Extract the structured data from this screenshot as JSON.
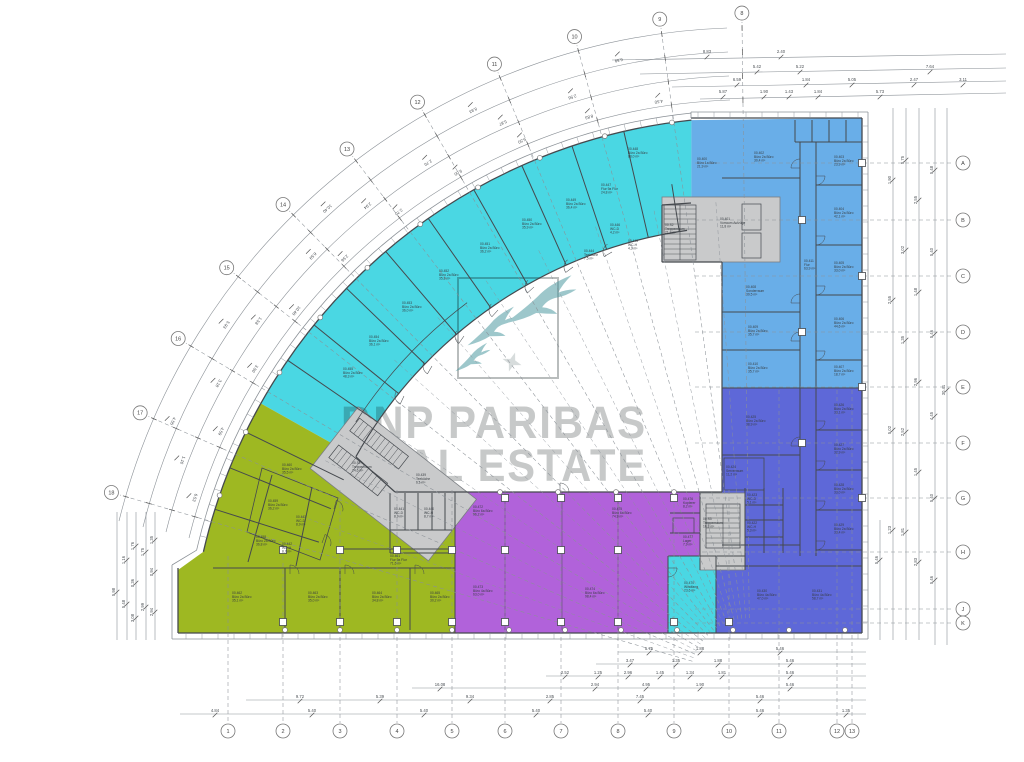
{
  "watermark": {
    "line1": "BNP PARIBAS",
    "line2": "REAL ESTATE",
    "color": "#c7c9c9",
    "logo": "bnp-paribas-swallows-logo",
    "logo_stroke": "#b9bdbd",
    "bird_color": "#4e9aa0",
    "star_color": "#cdd3d3"
  },
  "palette": {
    "cyan": "#4ad7e3",
    "blue": "#69aee8",
    "indigo": "#5e68d8",
    "purple": "#b162da",
    "green": "#9eb822",
    "core_gray": "#c9cacb",
    "wall": "#45494e",
    "dim": "#8b9197",
    "label": "#383d42",
    "background": "#ffffff"
  },
  "zones": [
    {
      "id": "curve-north",
      "color_key": "cyan"
    },
    {
      "id": "wing-east-upper",
      "color_key": "blue"
    },
    {
      "id": "wing-east-lower",
      "color_key": "indigo"
    },
    {
      "id": "wing-south-left",
      "color_key": "green"
    },
    {
      "id": "wing-south-center",
      "color_key": "purple"
    },
    {
      "id": "lobby-south",
      "color_key": "cyan"
    }
  ],
  "grid": {
    "bottom": {
      "y": 731,
      "items": [
        {
          "x": 228,
          "label": "1"
        },
        {
          "x": 283,
          "label": "2"
        },
        {
          "x": 340,
          "label": "3"
        },
        {
          "x": 397,
          "label": "4"
        },
        {
          "x": 452,
          "label": "5"
        },
        {
          "x": 505,
          "label": "6"
        },
        {
          "x": 561,
          "label": "7"
        },
        {
          "x": 618,
          "label": "8"
        },
        {
          "x": 674,
          "label": "9"
        },
        {
          "x": 729,
          "label": "10"
        },
        {
          "x": 779,
          "label": "11"
        },
        {
          "x": 837,
          "label": "12"
        },
        {
          "x": 852,
          "label": "13"
        }
      ]
    },
    "right": {
      "x": 963,
      "items": [
        {
          "y": 163,
          "label": "A"
        },
        {
          "y": 220,
          "label": "B"
        },
        {
          "y": 276,
          "label": "C"
        },
        {
          "y": 332,
          "label": "D"
        },
        {
          "y": 387,
          "label": "E"
        },
        {
          "y": 443,
          "label": "F"
        },
        {
          "y": 498,
          "label": "G"
        },
        {
          "y": 552,
          "label": "H"
        },
        {
          "y": 609,
          "label": "J"
        },
        {
          "y": 623,
          "label": "K"
        }
      ]
    },
    "arc": {
      "r": 665,
      "items": [
        {
          "phi": 269.3,
          "label": "8"
        },
        {
          "phi": 262.2,
          "label": "9"
        },
        {
          "phi": 254.7,
          "label": "10"
        },
        {
          "phi": 247.4,
          "label": "11"
        },
        {
          "phi": 240.0,
          "label": "12"
        },
        {
          "phi": 232.7,
          "label": "13"
        },
        {
          "phi": 225.4,
          "label": "14"
        },
        {
          "phi": 218.1,
          "label": "15"
        },
        {
          "phi": 210.7,
          "label": "16"
        },
        {
          "phi": 203.5,
          "label": "17"
        },
        {
          "phi": 196.2,
          "label": "18"
        }
      ]
    }
  },
  "dim_numbers": {
    "top": [
      {
        "x": 707,
        "y": 53,
        "t": "8.83"
      },
      {
        "x": 781,
        "y": 53,
        "t": "2.40"
      },
      {
        "x": 757,
        "y": 68,
        "t": "5.42"
      },
      {
        "x": 800,
        "y": 68,
        "t": "5.22"
      },
      {
        "x": 930,
        "y": 68,
        "t": "7.64"
      },
      {
        "x": 737,
        "y": 81,
        "t": "6.59"
      },
      {
        "x": 806,
        "y": 81,
        "t": "1.84"
      },
      {
        "x": 852,
        "y": 81,
        "t": "5.05"
      },
      {
        "x": 914,
        "y": 81,
        "t": "2.47"
      },
      {
        "x": 963,
        "y": 81,
        "t": "3.11"
      },
      {
        "x": 723,
        "y": 93,
        "t": "5.87"
      },
      {
        "x": 764,
        "y": 93,
        "t": "1.90"
      },
      {
        "x": 789,
        "y": 93,
        "t": "1.43"
      },
      {
        "x": 818,
        "y": 93,
        "t": "1.84"
      },
      {
        "x": 880,
        "y": 93,
        "t": "5.73"
      }
    ],
    "bottom": [
      {
        "x": 649,
        "y": 650,
        "t": "5.75"
      },
      {
        "x": 700,
        "y": 650,
        "t": "1.88"
      },
      {
        "x": 780,
        "y": 650,
        "t": "5.46"
      },
      {
        "x": 630,
        "y": 662,
        "t": "3.47"
      },
      {
        "x": 676,
        "y": 662,
        "t": "1.35"
      },
      {
        "x": 718,
        "y": 662,
        "t": "1.88"
      },
      {
        "x": 790,
        "y": 662,
        "t": "5.46"
      },
      {
        "x": 565,
        "y": 674,
        "t": "2.52"
      },
      {
        "x": 598,
        "y": 674,
        "t": "1.25"
      },
      {
        "x": 628,
        "y": 674,
        "t": "2.96"
      },
      {
        "x": 660,
        "y": 674,
        "t": "1.45"
      },
      {
        "x": 690,
        "y": 674,
        "t": "1.34"
      },
      {
        "x": 722,
        "y": 674,
        "t": "1.81"
      },
      {
        "x": 790,
        "y": 674,
        "t": "5.46"
      },
      {
        "x": 440,
        "y": 686,
        "t": "16.08"
      },
      {
        "x": 595,
        "y": 686,
        "t": "2.94"
      },
      {
        "x": 646,
        "y": 686,
        "t": "4.95"
      },
      {
        "x": 700,
        "y": 686,
        "t": "1.90"
      },
      {
        "x": 790,
        "y": 686,
        "t": "5.46"
      },
      {
        "x": 300,
        "y": 698,
        "t": "9.72"
      },
      {
        "x": 380,
        "y": 698,
        "t": "5.39"
      },
      {
        "x": 470,
        "y": 698,
        "t": "9.34"
      },
      {
        "x": 550,
        "y": 698,
        "t": "2.85"
      },
      {
        "x": 640,
        "y": 698,
        "t": "7.45"
      },
      {
        "x": 760,
        "y": 698,
        "t": "5.46"
      },
      {
        "x": 215,
        "y": 712,
        "t": "4.84"
      },
      {
        "x": 312,
        "y": 712,
        "t": "5.40"
      },
      {
        "x": 424,
        "y": 712,
        "t": "5.40"
      },
      {
        "x": 536,
        "y": 712,
        "t": "5.40"
      },
      {
        "x": 648,
        "y": 712,
        "t": "5.40"
      },
      {
        "x": 760,
        "y": 712,
        "t": "5.46"
      },
      {
        "x": 846,
        "y": 712,
        "t": "1.35"
      }
    ],
    "left": [
      {
        "x": 117,
        "y": 592,
        "t": "5.98"
      },
      {
        "x": 127,
        "y": 560,
        "t": "1.16"
      },
      {
        "x": 127,
        "y": 604,
        "t": "5.48"
      },
      {
        "x": 136,
        "y": 546,
        "t": "1.76"
      },
      {
        "x": 136,
        "y": 583,
        "t": "0.36"
      },
      {
        "x": 136,
        "y": 618,
        "t": "3.08"
      },
      {
        "x": 146,
        "y": 552,
        "t": "1.75"
      },
      {
        "x": 146,
        "y": 607,
        "t": "2.99"
      },
      {
        "x": 155,
        "y": 540,
        "t": "1.35"
      },
      {
        "x": 155,
        "y": 572,
        "t": "0.94"
      },
      {
        "x": 155,
        "y": 612,
        "t": "2.94"
      }
    ],
    "right": [
      {
        "x": 880,
        "y": 560,
        "t": "5.46"
      },
      {
        "x": 893,
        "y": 180,
        "t": "1.90"
      },
      {
        "x": 893,
        "y": 300,
        "t": "2.55"
      },
      {
        "x": 893,
        "y": 430,
        "t": "5.02"
      },
      {
        "x": 893,
        "y": 530,
        "t": "1.23"
      },
      {
        "x": 906,
        "y": 160,
        "t": "5.75"
      },
      {
        "x": 906,
        "y": 250,
        "t": "3.02"
      },
      {
        "x": 906,
        "y": 340,
        "t": "1.35"
      },
      {
        "x": 906,
        "y": 432,
        "t": "2.52"
      },
      {
        "x": 906,
        "y": 532,
        "t": "1.81"
      },
      {
        "x": 919,
        "y": 200,
        "t": "2.55"
      },
      {
        "x": 919,
        "y": 292,
        "t": "1.48"
      },
      {
        "x": 919,
        "y": 382,
        "t": "2.96"
      },
      {
        "x": 919,
        "y": 472,
        "t": "1.45"
      },
      {
        "x": 919,
        "y": 562,
        "t": "2.83"
      },
      {
        "x": 935,
        "y": 170,
        "t": "5.48"
      },
      {
        "x": 935,
        "y": 252,
        "t": "5.40"
      },
      {
        "x": 935,
        "y": 334,
        "t": "5.46"
      },
      {
        "x": 935,
        "y": 416,
        "t": "4.45"
      },
      {
        "x": 935,
        "y": 498,
        "t": "5.40"
      },
      {
        "x": 935,
        "y": 580,
        "t": "5.46"
      },
      {
        "x": 947,
        "y": 390,
        "t": "30.41"
      }
    ],
    "arc": [
      {
        "phi": 198,
        "r": 590,
        "t": "6.53"
      },
      {
        "phi": 205,
        "r": 590,
        "t": "4.59"
      },
      {
        "phi": 212,
        "r": 590,
        "t": "3.50"
      },
      {
        "phi": 219,
        "r": 590,
        "t": "10.40"
      },
      {
        "phi": 226,
        "r": 590,
        "t": "2.56"
      },
      {
        "phi": 233,
        "r": 590,
        "t": "2.70"
      },
      {
        "phi": 240,
        "r": 590,
        "t": "9.00"
      },
      {
        "phi": 247,
        "r": 590,
        "t": "6.50"
      },
      {
        "phi": 254,
        "r": 590,
        "t": "8.83"
      },
      {
        "phi": 261,
        "r": 590,
        "t": "4.50"
      },
      {
        "phi": 201,
        "r": 614,
        "t": "1.10"
      },
      {
        "phi": 209,
        "r": 614,
        "t": "3.18"
      },
      {
        "phi": 216,
        "r": 614,
        "t": "1.58"
      },
      {
        "phi": 224,
        "r": 614,
        "t": "6.59"
      },
      {
        "phi": 231,
        "r": 614,
        "t": "2.94"
      },
      {
        "phi": 238,
        "r": 614,
        "t": "2.70"
      },
      {
        "phi": 246,
        "r": 614,
        "t": "5.87"
      },
      {
        "phi": 253,
        "r": 614,
        "t": "2.56"
      },
      {
        "phi": 204,
        "r": 638,
        "t": "4.55"
      },
      {
        "phi": 214,
        "r": 638,
        "t": "5.93"
      },
      {
        "phi": 228,
        "r": 638,
        "t": "10.40"
      },
      {
        "phi": 244,
        "r": 638,
        "t": "8.83"
      },
      {
        "phi": 258,
        "r": 638,
        "t": "6.59"
      }
    ]
  },
  "rooms": [
    {
      "x": 343,
      "y": 370,
      "lines": [
        "00.455",
        "Büro 2a Büro",
        "48,3 m²"
      ]
    },
    {
      "x": 369,
      "y": 338,
      "lines": [
        "00.454",
        "Büro 2a Büro",
        "36,1 m²"
      ]
    },
    {
      "x": 402,
      "y": 304,
      "lines": [
        "00.453",
        "Büro 2a Büro",
        "36,0 m²"
      ]
    },
    {
      "x": 439,
      "y": 272,
      "lines": [
        "00.452",
        "Büro 2a Büro",
        "35,8 m²"
      ]
    },
    {
      "x": 480,
      "y": 245,
      "lines": [
        "00.451",
        "Büro 2a Büro",
        "36,2 m²"
      ]
    },
    {
      "x": 522,
      "y": 221,
      "lines": [
        "00.450",
        "Büro 2a Büro",
        "35,9 m²"
      ]
    },
    {
      "x": 566,
      "y": 201,
      "lines": [
        "00.449",
        "Büro 2a Büro",
        "36,4 m²"
      ]
    },
    {
      "x": 628,
      "y": 150,
      "lines": [
        "00.448",
        "Büro 2a Büro",
        "88,0 m²"
      ]
    },
    {
      "x": 601,
      "y": 186,
      "lines": [
        "00.447",
        "Flur 9a Flur",
        "24,8 m²"
      ]
    },
    {
      "x": 610,
      "y": 226,
      "lines": [
        "00.446",
        "WC-D",
        "4,2 m²"
      ]
    },
    {
      "x": 628,
      "y": 242,
      "lines": [
        "00.445",
        "WC-H",
        "4,3 m²"
      ]
    },
    {
      "x": 584,
      "y": 252,
      "lines": [
        "00.444",
        "Teeküche",
        "7,5 m²"
      ]
    },
    {
      "x": 697,
      "y": 160,
      "lines": [
        "00.400",
        "Büro 1a Büro",
        "21,9 m²"
      ]
    },
    {
      "x": 665,
      "y": 226,
      "lines": [
        "00.S2",
        "Treppenraum",
        "21,3 m²"
      ]
    },
    {
      "x": 720,
      "y": 220,
      "lines": [
        "00.401",
        "Vorraum Aufzüge",
        "11,8 m²"
      ]
    },
    {
      "x": 754,
      "y": 154,
      "lines": [
        "00.402",
        "Büro 2a Büro",
        "30,4 m²"
      ]
    },
    {
      "x": 834,
      "y": 158,
      "lines": [
        "00.403",
        "Büro 2a Büro",
        "23,9 m²"
      ]
    },
    {
      "x": 834,
      "y": 210,
      "lines": [
        "00.404",
        "Büro 2a Büro",
        "42,1 m²"
      ]
    },
    {
      "x": 834,
      "y": 264,
      "lines": [
        "00.405",
        "Büro 2a Büro",
        "33,0 m²"
      ]
    },
    {
      "x": 834,
      "y": 320,
      "lines": [
        "00.406",
        "Büro 2a Büro",
        "44,6 m²"
      ]
    },
    {
      "x": 834,
      "y": 368,
      "lines": [
        "00.407",
        "Büro 2a Büro",
        "18,7 m²"
      ]
    },
    {
      "x": 746,
      "y": 288,
      "lines": [
        "00.408",
        "Sonderraum",
        "39,5 m²"
      ]
    },
    {
      "x": 748,
      "y": 328,
      "lines": [
        "00.409",
        "Büro 2a Büro",
        "35,7 m²"
      ]
    },
    {
      "x": 748,
      "y": 365,
      "lines": [
        "00.410",
        "Büro 2a Büro",
        "35,7 m²"
      ]
    },
    {
      "x": 804,
      "y": 262,
      "lines": [
        "00.411",
        "Flur",
        "63,9 m²"
      ]
    },
    {
      "x": 834,
      "y": 406,
      "lines": [
        "00.426",
        "Büro 2a Büro",
        "33,1 m²"
      ]
    },
    {
      "x": 834,
      "y": 446,
      "lines": [
        "00.427",
        "Büro 2a Büro",
        "32,9 m²"
      ]
    },
    {
      "x": 834,
      "y": 486,
      "lines": [
        "00.428",
        "Büro 2a Büro",
        "33,0 m²"
      ]
    },
    {
      "x": 834,
      "y": 526,
      "lines": [
        "00.429",
        "Büro 2a Büro",
        "33,4 m²"
      ]
    },
    {
      "x": 746,
      "y": 418,
      "lines": [
        "00.425",
        "Büro 2a Büro",
        "38,9 m²"
      ]
    },
    {
      "x": 726,
      "y": 468,
      "lines": [
        "00.424",
        "Serverraum",
        "11,2 m²"
      ]
    },
    {
      "x": 747,
      "y": 496,
      "lines": [
        "00.423",
        "WC-D",
        "5,1 m²"
      ]
    },
    {
      "x": 747,
      "y": 524,
      "lines": [
        "00.422",
        "WC-H",
        "5,3 m²"
      ]
    },
    {
      "x": 703,
      "y": 520,
      "lines": [
        "00.S3",
        "Treppenraum",
        "16,8 m²"
      ]
    },
    {
      "x": 757,
      "y": 592,
      "lines": [
        "00.430",
        "Büro 4a Büro",
        "47,0 m²"
      ]
    },
    {
      "x": 812,
      "y": 592,
      "lines": [
        "00.431",
        "Büro 4a Büro",
        "58,7 m²"
      ]
    },
    {
      "x": 684,
      "y": 584,
      "lines": [
        "00.470",
        "Windfang",
        "23,6 m²"
      ]
    },
    {
      "x": 473,
      "y": 508,
      "lines": [
        "00.472",
        "Büro 6a Büro",
        "96,2 m²"
      ]
    },
    {
      "x": 473,
      "y": 588,
      "lines": [
        "00.473",
        "Büro 4a Büro",
        "63,0 m²"
      ]
    },
    {
      "x": 585,
      "y": 590,
      "lines": [
        "00.474",
        "Büro 6a Büro",
        "98,4 m²"
      ]
    },
    {
      "x": 612,
      "y": 510,
      "lines": [
        "00.475",
        "Büro 6a Büro",
        "74,9 m²"
      ]
    },
    {
      "x": 683,
      "y": 500,
      "lines": [
        "00.476",
        "Kopierer",
        "8,2 m²"
      ]
    },
    {
      "x": 683,
      "y": 538,
      "lines": [
        "00.477",
        "Lager",
        "7,9 m²"
      ]
    },
    {
      "x": 232,
      "y": 594,
      "lines": [
        "00.462",
        "Büro 2a Büro",
        "35,1 m²"
      ]
    },
    {
      "x": 308,
      "y": 594,
      "lines": [
        "00.463",
        "Büro 2a Büro",
        "35,0 m²"
      ]
    },
    {
      "x": 372,
      "y": 594,
      "lines": [
        "00.464",
        "Büro 2a Büro",
        "34,8 m²"
      ]
    },
    {
      "x": 430,
      "y": 594,
      "lines": [
        "00.465",
        "Büro 2a Büro",
        "30,2 m²"
      ]
    },
    {
      "x": 390,
      "y": 557,
      "lines": [
        "00.461",
        "Flur 9a Flur",
        "71,6 m²"
      ]
    },
    {
      "x": 394,
      "y": 510,
      "lines": [
        "00.441",
        "WC-D",
        "8,9 m²"
      ]
    },
    {
      "x": 424,
      "y": 510,
      "lines": [
        "00.440",
        "WC-H",
        "8,7 m²"
      ]
    },
    {
      "x": 416,
      "y": 476,
      "lines": [
        "00.439",
        "Teeküche",
        "6,1 m²"
      ]
    },
    {
      "x": 256,
      "y": 538,
      "lines": [
        "00.458",
        "Büro 2a Büro",
        "36,8 m²"
      ]
    },
    {
      "x": 268,
      "y": 502,
      "lines": [
        "00.459",
        "Büro 2a Büro",
        "36,2 m²"
      ]
    },
    {
      "x": 282,
      "y": 466,
      "lines": [
        "00.460",
        "Büro 2a Büro",
        "35,5 m²"
      ]
    },
    {
      "x": 352,
      "y": 464,
      "lines": [
        "00.S1",
        "Treppenraum",
        "24,6 m²"
      ]
    },
    {
      "x": 296,
      "y": 518,
      "lines": [
        "00.443",
        "WC-D",
        "8,9 m²"
      ]
    },
    {
      "x": 282,
      "y": 545,
      "lines": [
        "00.442",
        "WC-H",
        "8,7 m²"
      ]
    }
  ]
}
